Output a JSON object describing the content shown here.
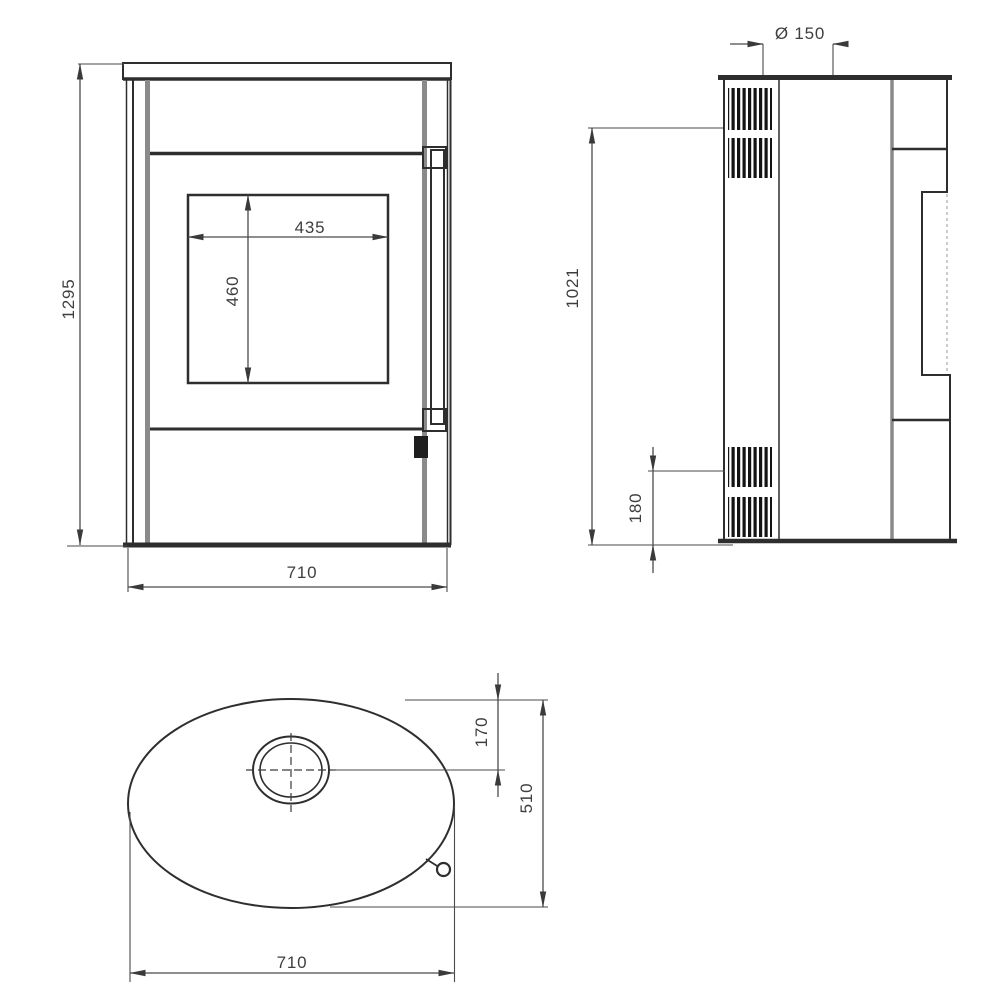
{
  "drawing": {
    "type": "stove-dimension-drawing",
    "colors": {
      "background": "#ffffff",
      "line": "#2e2e2e",
      "grey_line": "#8a8a8a",
      "dimension": "#4a4a4a",
      "text": "#3e3e3e",
      "grille": "#141414"
    },
    "views": {
      "front": {
        "overall_height": "1295",
        "overall_width": "710",
        "glass_width": "435",
        "glass_height": "460"
      },
      "side": {
        "flue_diameter": "Ø 150",
        "flue_height": "1021",
        "vent_height": "180"
      },
      "top": {
        "flue_center_offset": "170",
        "depth": "510",
        "width": "710"
      }
    }
  }
}
